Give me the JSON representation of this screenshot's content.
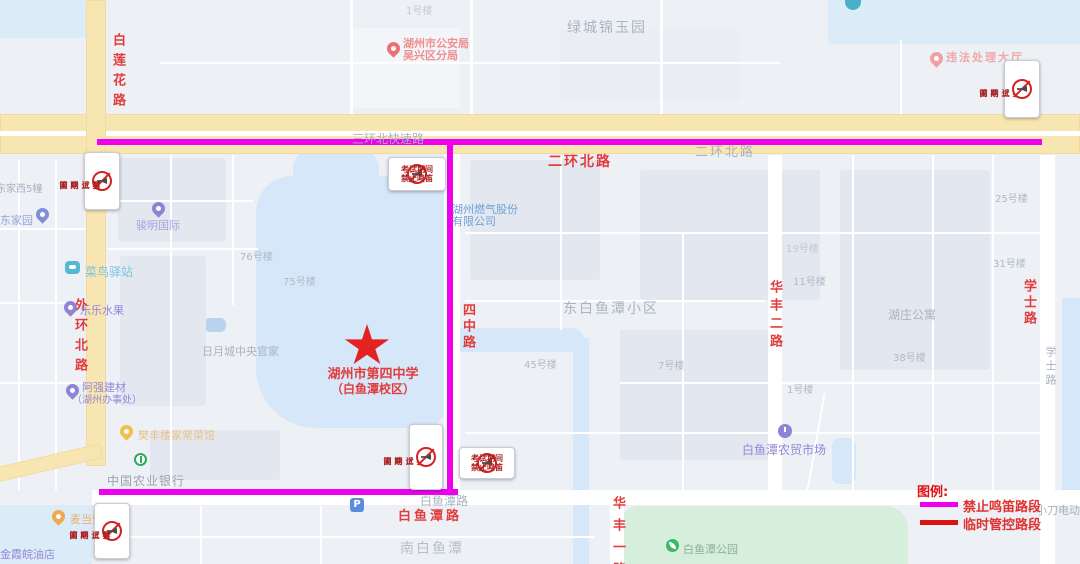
{
  "map_title": "school exam traffic-control map",
  "colors": {
    "no_horn_route": "#ee00ee",
    "temp_control_route": "#dd1111",
    "road_label_red": "#e23c3c",
    "major_road_yellow": "#f8e6b2",
    "water_blue": "#d5e7f8",
    "park_green": "#d6eedc"
  },
  "school": {
    "name_line1": "湖州市第四中学",
    "name_line2": "（白鱼潭校区）",
    "star_color": "#e32222"
  },
  "sign": {
    "line1": "考试期间",
    "line2": "禁止鸣笛"
  },
  "roads": {
    "bailianhua": "白莲花路",
    "waihuanbei": "外环北路",
    "sanhuanbei_expwy": "三环北快速路",
    "erhuanbei_red": "二环北路",
    "erhuanbei_gray": "二环北路",
    "sizhong": "四中路",
    "huafeng2": "华丰二路",
    "xueshi_red": "学士路",
    "xueshi_gray": "学士路",
    "baiyutan_red": "白鱼潭路",
    "baiyutan_gray": "白鱼潭路",
    "huafeng1": "华丰一路"
  },
  "areas": {
    "lvcheng": "绿城锦玉园",
    "dongbaiyutan": "东白鱼潭小区",
    "nanbaiyutan": "南白鱼潭",
    "huzhuang": "湖庄公寓",
    "riyuecheng": "日月城中央官家",
    "dongjiaxi5": "东家西5幢"
  },
  "buildings": {
    "b1_top": "1号楼",
    "b76": "76号楼",
    "b75": "75号楼",
    "b45": "45号楼",
    "b7": "7号楼",
    "b19": "19号楼",
    "b11": "11号楼",
    "b31": "31号楼",
    "b38": "38号楼",
    "b1_right": "1号楼",
    "b25": "25号楼"
  },
  "pois": {
    "police_line1": "湖州市公安局",
    "police_line2": "吴兴区分局",
    "weifa": "违法处理大厅",
    "junming": "骏明国际",
    "dongjiayuan": "东家园",
    "cainiao": "菜鸟驿站",
    "lele": "乐乐水果",
    "gas_line1": "湖州燃气股份",
    "gas_line2": "有限公司",
    "aqiang_line1": "阿强建材",
    "aqiang_line2": "（湖州办事处）",
    "fanfeng": "樊丰楼家常菜馆",
    "bank": "中国农业银行",
    "mcdonalds": "麦当劳",
    "jinxia": "金霞皖油店",
    "market": "白鱼潭农贸市场",
    "park": "白鱼潭公园",
    "xiaodao": "小刀电动车",
    "parking_label": "P"
  },
  "legend": {
    "title": "图例:",
    "items": [
      {
        "label": "禁止鸣笛路段",
        "color": "#ee00ee"
      },
      {
        "label": "临时管控路段",
        "color": "#dd1111"
      }
    ]
  }
}
